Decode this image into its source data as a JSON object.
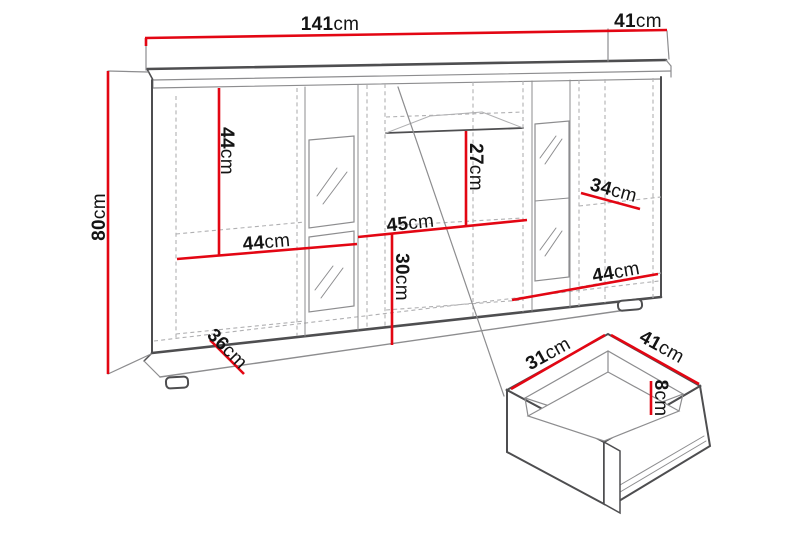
{
  "figure": {
    "type": "furniture-dimension-diagram",
    "views": [
      "sideboard-front-perspective",
      "drawer-detail-isometric"
    ]
  },
  "colors": {
    "dimension_red": "#e30613",
    "line_dark": "#4e4e50",
    "line_mid": "#8d8d8f",
    "line_light": "#b0b0b2",
    "label_text": "#141414",
    "background": "#ffffff"
  },
  "cabinet": {
    "dimensions": {
      "width_top": {
        "value": "141",
        "unit": "cm"
      },
      "depth_top": {
        "value": "41",
        "unit": "cm"
      },
      "height": {
        "value": "80",
        "unit": "cm"
      },
      "left_door_height": {
        "value": "44",
        "unit": "cm"
      },
      "left_shelf_width": {
        "value": "44",
        "unit": "cm"
      },
      "base_depth": {
        "value": "36",
        "unit": "cm"
      },
      "center_upper_height": {
        "value": "27",
        "unit": "cm"
      },
      "center_width": {
        "value": "45",
        "unit": "cm"
      },
      "center_lower_height": {
        "value": "30",
        "unit": "cm"
      },
      "right_shelf_depth": {
        "value": "34",
        "unit": "cm"
      },
      "right_section_width": {
        "value": "44",
        "unit": "cm"
      }
    }
  },
  "drawer": {
    "dimensions": {
      "inner_depth": {
        "value": "31",
        "unit": "cm"
      },
      "width": {
        "value": "41",
        "unit": "cm"
      },
      "inner_height": {
        "value": "8",
        "unit": "cm"
      }
    }
  }
}
